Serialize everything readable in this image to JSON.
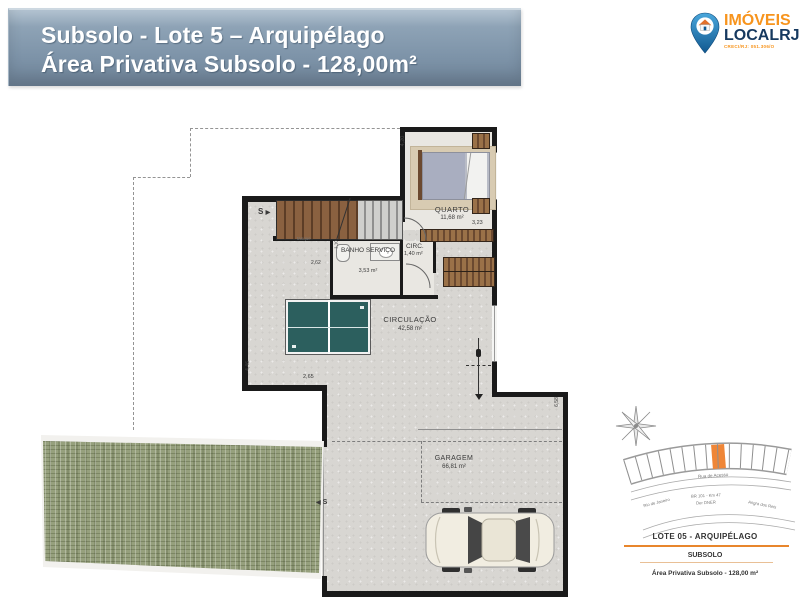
{
  "header": {
    "title_line1": "Subsolo - Lote 5 – Arquipélago",
    "title_line2": "Área Privativa Subsolo - 128,00m²"
  },
  "logo": {
    "brand_line1": "IMÓVEIS",
    "brand_line2": "LOCALRJ",
    "creci": "CRECI/RJ: 051.306/O"
  },
  "plan": {
    "rooms": {
      "quarto": {
        "name": "QUARTO",
        "area": "11,68 m²"
      },
      "banho_servico": {
        "name": "BANHO SERVIÇO",
        "area": "3,53 m²"
      },
      "circ": {
        "name": "CIRC.",
        "area": "1,40 m²"
      },
      "circulacao": {
        "name": "CIRCULAÇÃO",
        "area": "42,58 m²"
      },
      "garagem": {
        "name": "GARAGEM",
        "area": "66,81 m²"
      }
    },
    "dimensions": {
      "quarto_height": "4,20",
      "quarto_width": "3,23",
      "banho_width": "1,10",
      "banho_height": "2,62",
      "circulacao_left": "4,46",
      "circulacao_bottom": "2,65",
      "garagem_right": "6,58"
    },
    "markers": {
      "stairs_up": "S",
      "stairs_arrow": "▶",
      "entry_arrow": "◀",
      "entry": "S",
      "service_note": "tanque"
    }
  },
  "minimap": {
    "access_road": "Rua de Acesso",
    "road_left": "Rio de Janeiro",
    "highway_line1": "BR 101 - Km 47",
    "highway_line2": "Der DNER",
    "road_right": "Angra dos Reis",
    "lot_title": "LOTE 05 - ARQUIPÉLAGO",
    "floor_label": "SUBSOLO",
    "area_caption": "Área Privativa Subsolo - 128,00 m²"
  }
}
